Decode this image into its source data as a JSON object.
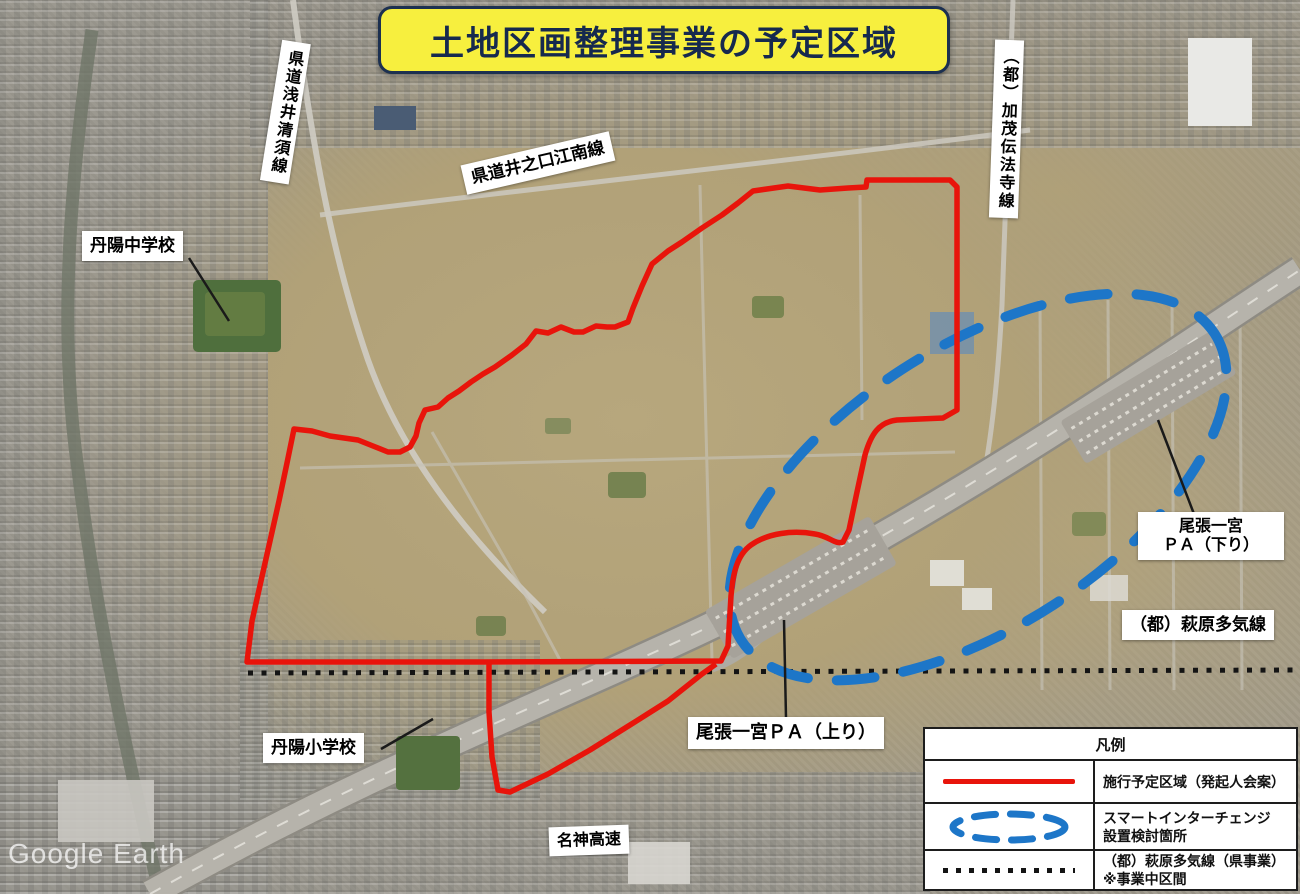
{
  "title": {
    "text": "土地区画整理事業の予定区域"
  },
  "watermark": {
    "text": "Google Earth"
  },
  "labels": {
    "asai_kiyosu": "県道浅井清須線",
    "tanyo_junior_high": "丹陽中学校",
    "inokuchi_konan": "県道井之口江南線",
    "kamo_denpoji": "（都）加茂伝法寺線",
    "pa_kudari_line1": "尾張一宮",
    "pa_kudari_line2": "ＰＡ（下り）",
    "hagiwara_taki": "（都）萩原多気線",
    "pa_nobori": "尾張一宮ＰＡ（上り）",
    "tanyo_elementary": "丹陽小学校",
    "meishin_expwy": "名神高速"
  },
  "legend": {
    "title": "凡例",
    "items": [
      {
        "id": "planned-area",
        "symbol": "red-solid-line",
        "color": "#e8140b",
        "lines": [
          "施行予定区域（発起人会案）"
        ]
      },
      {
        "id": "smart-interchange",
        "symbol": "blue-dashed-ellipse",
        "color": "#1d76c8",
        "lines": [
          "スマートインターチェンジ",
          "設置検討箇所"
        ]
      },
      {
        "id": "hagiwara-taki-line",
        "symbol": "black-dotted-line",
        "color": "#141414",
        "lines": [
          "（都）萩原多気線（県事業）",
          "※事業中区間"
        ]
      }
    ]
  },
  "colors": {
    "title_bg": "#f7ef3e",
    "title_text": "#16294e",
    "boundary_red": "#e8140b",
    "smart_ic_blue": "#1d76c8",
    "dotted_black": "#141414",
    "label_bg": "#ffffff"
  }
}
